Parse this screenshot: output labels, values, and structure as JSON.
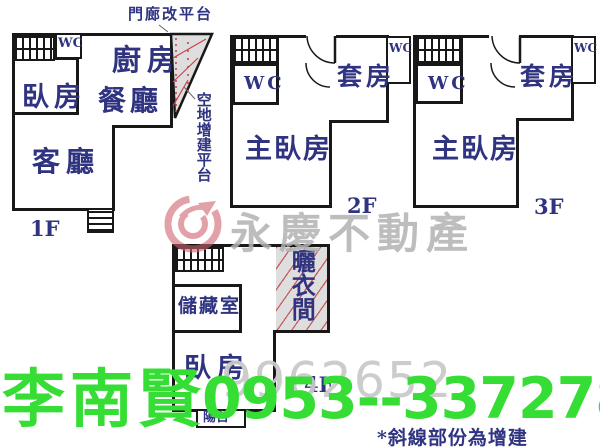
{
  "f1": {
    "floor": "1F",
    "wc": "WC",
    "bedroom": "臥房",
    "kitchen": "廚房",
    "dining": "餐廳",
    "living": "客廳",
    "porch_note": "門廊改平台",
    "side_note": "空地增建平台"
  },
  "f2": {
    "floor": "2F",
    "wc": "WC",
    "wc2": "WC",
    "suite": "套房",
    "master": "主臥房"
  },
  "f3": {
    "floor": "3F",
    "wc": "WC",
    "wc2": "WC",
    "suite": "套房",
    "master": "主臥房"
  },
  "f4": {
    "floor": "4F",
    "storage": "儲藏室",
    "drying": "曬衣間",
    "bedroom": "臥房",
    "balcony": "陽台"
  },
  "watermark": {
    "brand": "永慶不動產",
    "serial": "9962652"
  },
  "contact": {
    "name": "李南賢",
    "phone": "0953--337278"
  },
  "legend": "*斜線部份為增建",
  "colors": {
    "label_navy": "#2f3380",
    "wall_black": "#181818",
    "hatch_red": "#c3464b",
    "hatch_bg": "#dedede",
    "logo_pink": "#cf6470",
    "watermark_gray": "#b2b2b2",
    "contact_green": "#35dd35"
  }
}
